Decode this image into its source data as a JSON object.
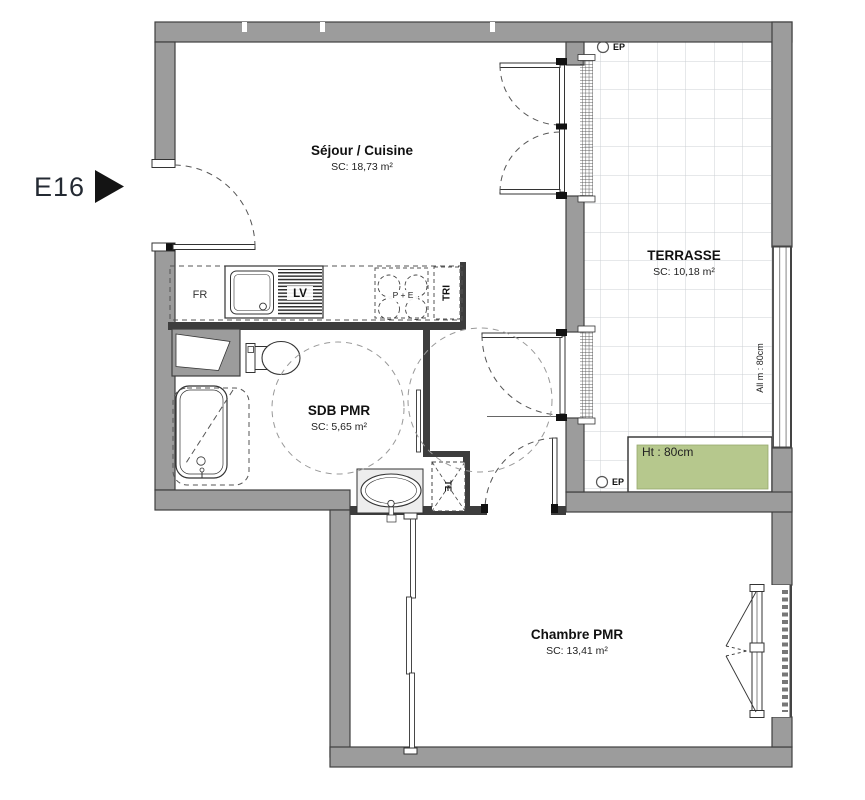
{
  "plan": {
    "unit": "E16",
    "rooms": [
      {
        "id": "sejour",
        "name": "Séjour / Cuisine",
        "area": "SC: 18,73 m²"
      },
      {
        "id": "terrasse",
        "name": "TERRASSE",
        "area": "SC: 10,18 m²"
      },
      {
        "id": "sdb",
        "name": "SDB PMR",
        "area": "SC: 5,65 m²"
      },
      {
        "id": "chambre",
        "name": "Chambre PMR",
        "area": "SC: 13,41 m²"
      }
    ],
    "annotations": {
      "fridge": "FR",
      "dishwasher": "LV",
      "waste_sorting": "TRI",
      "electrical_panel": "TE",
      "cooktop": "P + E",
      "ep_top": "EP",
      "ep_bottom": "EP",
      "planter_height": "Ht : 80cm",
      "sill_height": "All m : 80cm"
    },
    "colors": {
      "wall_gray": "#9c9c9c",
      "wall_edge": "#3f3f3f",
      "planter_green": "#b6c88d",
      "tile_line": "#ccd0d4"
    }
  }
}
